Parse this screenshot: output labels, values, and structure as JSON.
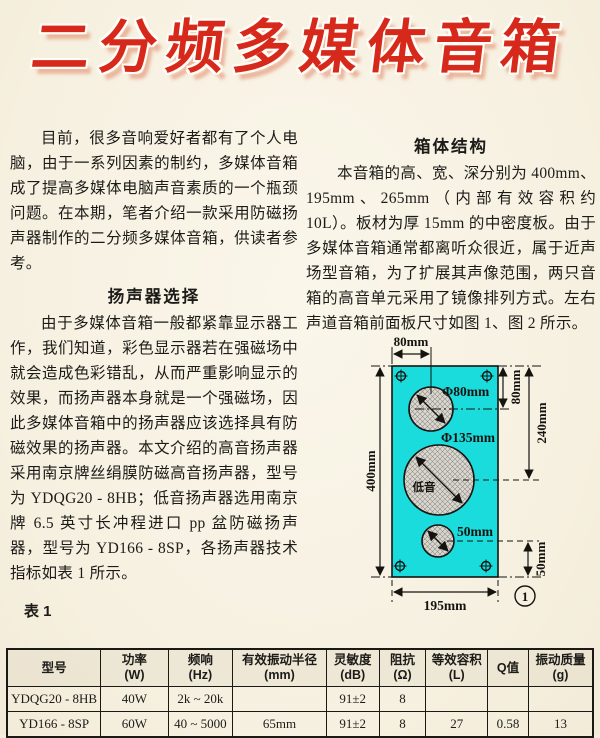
{
  "page_title": "二分频多媒体音箱",
  "article": {
    "intro": "目前，很多音响爱好者都有了个人电脑，由于一系列因素的制约，多媒体音箱成了提高多媒体电脑声音素质的一个瓶颈问题。在本期，笔者介绍一款采用防磁扬声器制作的二分频多媒体音箱，供读者参考。",
    "section1_heading": "扬声器选择",
    "section1_body": "由于多媒体音箱一般都紧靠显示器工作，我们知道，彩色显示器若在强磁场中就会造成色彩错乱，从而严重影响显示的效果，而扬声器本身就是一个强磁场，因此多媒体音箱中的扬声器应该选择具有防磁效果的扬声器。本文介绍的高音扬声器采用南京牌丝绢膜防磁高音扬声器，型号为 YDQG20 - 8HB；低音扬声器选用南京牌 6.5 英寸长冲程进口 pp 盆防磁扬声器，型号为 YD166 - 8SP，各扬声器技术指标如表 1 所示。",
    "table_label": "表 1",
    "section2_heading": "箱体结构",
    "section2_body": "本音箱的高、宽、深分别为 400mm、195mm、265mm（内部有效容积约 10L）。板材为厚 15mm 的中密度板。由于多媒体音箱通常都离听众很近，属于近声场型音箱，为了扩展其声像范围，两只音箱的高音单元采用了镜像排列方式。左右声道音箱前面板尺寸如图 1、图 2 所示。"
  },
  "diagram": {
    "panel_color": "#1bdcdc",
    "top_width": "80mm",
    "panel_height": "400mm",
    "panel_width": "195mm",
    "tweeter_diameter": "Φ80mm",
    "woofer_diameter": "Φ135mm",
    "woofer_text": "低音",
    "port_diameter": "50mm",
    "dim_right_top": "80mm",
    "dim_right_middle": "240mm",
    "dim_right_bottom": "50mm",
    "figure_number": "1"
  },
  "spec_table": {
    "headers": [
      "型号",
      "功率\n(W)",
      "频响\n(Hz)",
      "有效振动半径\n(mm)",
      "灵敏度\n(dB)",
      "阻抗\n(Ω)",
      "等效容积\n(L)",
      "Q值",
      "振动质量\n(g)"
    ],
    "rows": [
      [
        "YDQG20 - 8HB",
        "40W",
        "2k ~ 20k",
        "",
        "91±2",
        "8",
        "",
        "",
        ""
      ],
      [
        "YD166 - 8SP",
        "60W",
        "40 ~ 5000",
        "65mm",
        "91±2",
        "8",
        "27",
        "0.58",
        "13"
      ]
    ]
  }
}
